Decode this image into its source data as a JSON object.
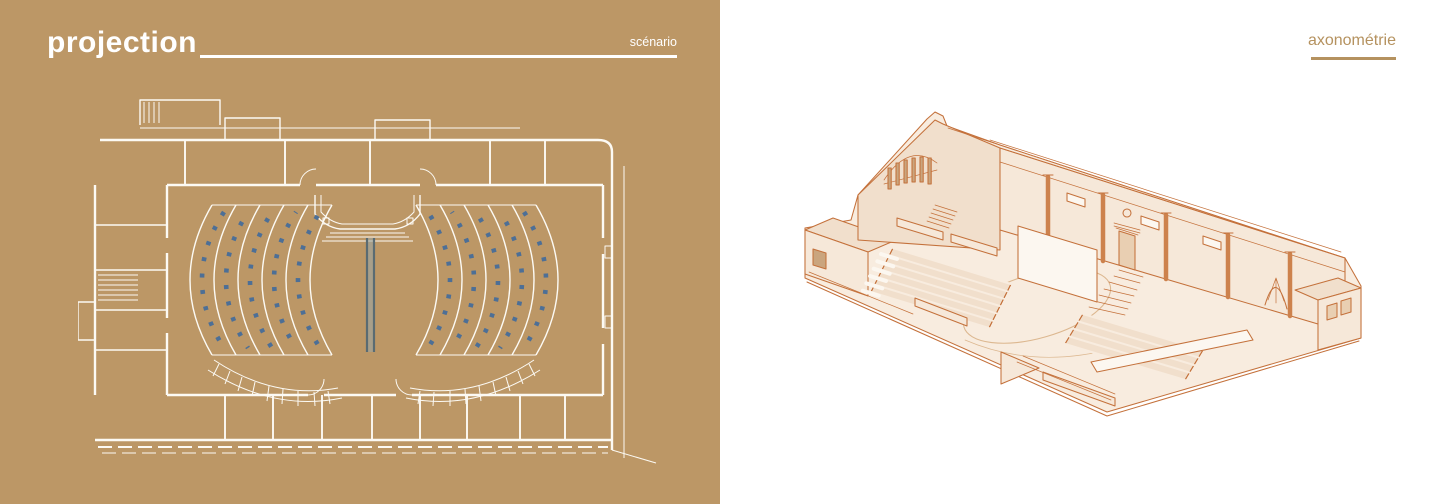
{
  "slide": {
    "left_panel": {
      "title": "projection",
      "tag": "scénario",
      "drawing": "theater-floor-plan"
    },
    "right_panel": {
      "tag": "axonométrie",
      "drawing": "auditorium-axonometric-cutaway"
    },
    "colors": {
      "tan_background": "#bc9766",
      "plan_line": "#fcfaf4",
      "plan_seat_blue": "#4d6f96",
      "screen_dark": "#5a6b72",
      "screen_light": "#98a5a8",
      "axon_line": "#c4713b",
      "axon_fill": "#f8ecdf",
      "axon_fill_shade": "#f1dfcc",
      "axon_seat_blue": "#5c6d83",
      "accent_underline": "#b5925f"
    }
  }
}
